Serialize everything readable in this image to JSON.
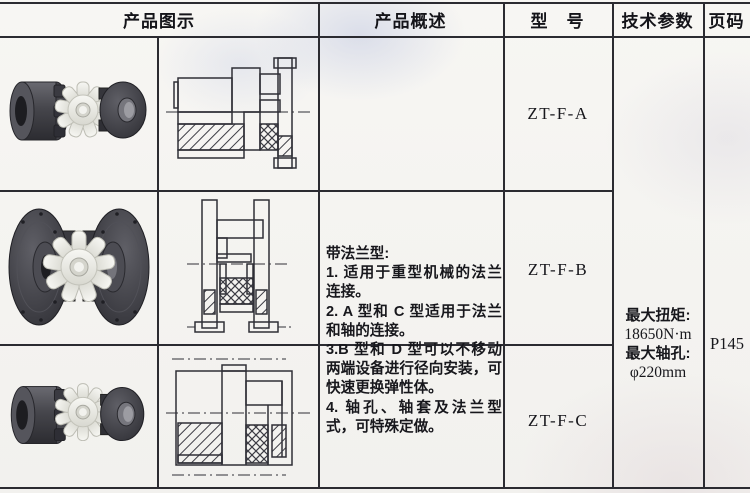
{
  "header": {
    "col_product_image": "产品图示",
    "col_product_overview": "产品概述",
    "col_model": "型　号",
    "col_tech_params": "技术参数",
    "col_page": "页码"
  },
  "overview": {
    "title": "带法兰型:",
    "items": [
      "1. 适用于重型机械的法兰连接。",
      "2. A 型和 C 型适用于法兰和轴的连接。",
      "3.B 型和 D 型可以不移动两端设备进行径向安装，可快速更换弹性体。",
      "4. 轴孔、轴套及法兰型式，可特殊定做。"
    ]
  },
  "models": [
    {
      "model": "ZT-F-A"
    },
    {
      "model": "ZT-F-B"
    },
    {
      "model": "ZT-F-C"
    }
  ],
  "tech_params": {
    "torque_label": "最大扭矩:",
    "torque_value": "18650N·m",
    "bore_label": "最大轴孔:",
    "bore_value": "φ220mm"
  },
  "page_code": "P145",
  "colors": {
    "line": "#2b2b31",
    "text": "#17171c",
    "paper": "#f6f5f2"
  }
}
